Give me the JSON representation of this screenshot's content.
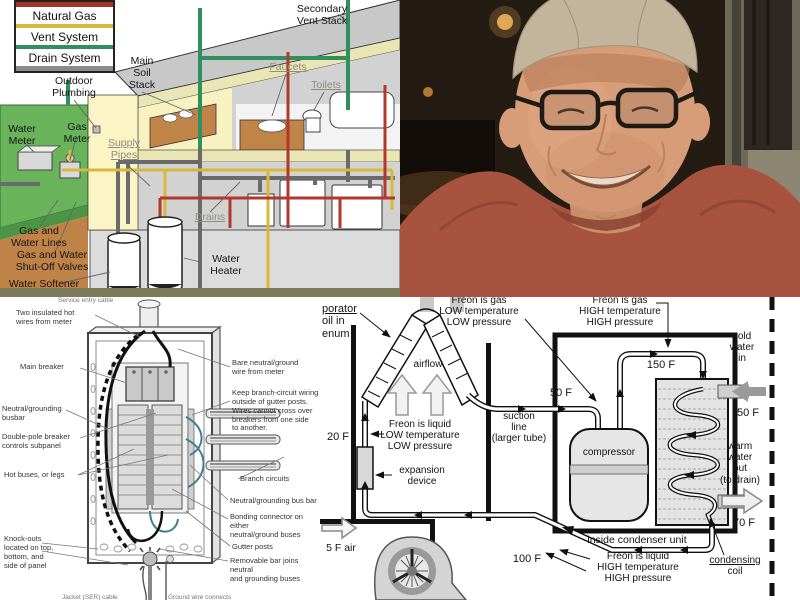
{
  "plumbing": {
    "legend": {
      "items": [
        {
          "label": "Natural Gas",
          "color": "#d8b83a"
        },
        {
          "label": "Vent System",
          "color": "#2f8f5f"
        },
        {
          "label": "Drain System",
          "color": "#8a8a8a"
        }
      ]
    },
    "labels": {
      "outdoor_plumbing": "Outdoor\nPlumbing",
      "main_soil_stack": "Main\nSoil\nStack",
      "secondary_vent_stack": "Secondary\nVent Stack",
      "water_meter": "Water\nMeter",
      "gas_meter": "Gas\nMeter",
      "supply_pipes": "Supply\nPipes",
      "faucets": "Faucets",
      "toilets": "Toilets",
      "drains": "Drains",
      "water_heater": "Water\nHeater",
      "gas_and_water_lines": "Gas and\nWater Lines",
      "gas_and_water_valves": "Gas and Water\nShut-Off Valves",
      "water_softener": "Water Softener"
    },
    "colors": {
      "gas_pipe": "#d8b83a",
      "vent_pipe": "#2f8f5f",
      "drain_pipe": "#6a6a6a",
      "supply_pipe": "#b1382a",
      "lawn": "#69b35a",
      "soil": "#bf8347",
      "wall": "#f7f2c0",
      "roof": "#c8c8c8"
    }
  },
  "photo": {
    "alt": "Smiling man wearing a light tan baseball cap and dark-rimmed glasses, rust-orange t-shirt, dim warm restaurant background",
    "colors": {
      "shirt": "#a75340",
      "cap": "#c3b59c",
      "skin": "#d79d79",
      "background": "#241b12"
    }
  },
  "electrical": {
    "labels": {
      "service_entry": "Service entry cable",
      "two_insulated": "Two insulated hot\nwires from meter",
      "main_breaker": "Main breaker",
      "neutral_busbar": "Neutral/grounding\nbusbar",
      "double_pole": "Double-pole breaker\ncontrols subpanel",
      "hot_buses": "Hot buses, or legs",
      "knockouts": "Knock-outs\nlocated on top,\nbottom, and\nside of panel",
      "bare_neutral": "Bare neutral/ground\nwire from meter",
      "keep_branch": "Keep branch-circuit wiring\noutside of gutter posts.\nWires cannot cross over\nbreakers from one side\nto another.",
      "branch_circuits": "Branch circuits",
      "neutral_bus_bar": "Neutral/grounding bus bar",
      "bonding_connector": "Bonding connector on either\nneutral/ground buses",
      "gutter_posts": "Gutter posts",
      "removable_bar": "Removable bar joins neutral\nand grounding buses",
      "bottom_left_clipped": "Jacket (SER) cable",
      "bottom_right_clipped": "Ground wire connects"
    }
  },
  "hvac": {
    "labels": {
      "evap_clip_1": "porator",
      "evap_clip_2": "oil in",
      "evap_clip_3": "enum",
      "freon_gas_low": "Freon is gas\nLOW temperature\nLOW pressure",
      "freon_gas_high": "Freon is gas\nHIGH temperature\nHIGH pressure",
      "freon_liquid_low": "Freon is liquid\nLOW temperature\nLOW pressure",
      "freon_liquid_high": "Freon is liquid\nHIGH temperature\nHIGH pressure",
      "airflow": "airflow",
      "suction_line": "suction\nline\n(larger tube)",
      "expansion_device": "expansion\ndevice",
      "compressor": "compressor",
      "inside_condenser": "inside condenser unit",
      "condensing_1": "condensing",
      "condensing_2": "coil",
      "cold_water_in": "cold\nwater\nin",
      "warm_water_out": "warm\nwater\nout\n(to drain)",
      "air_in": "5 F air"
    },
    "temps": {
      "t20": "20 F",
      "t50_suction": "50 F",
      "t150": "150 F",
      "t50_cold": "50 F",
      "t70": "70 F",
      "t100": "100 F"
    }
  }
}
